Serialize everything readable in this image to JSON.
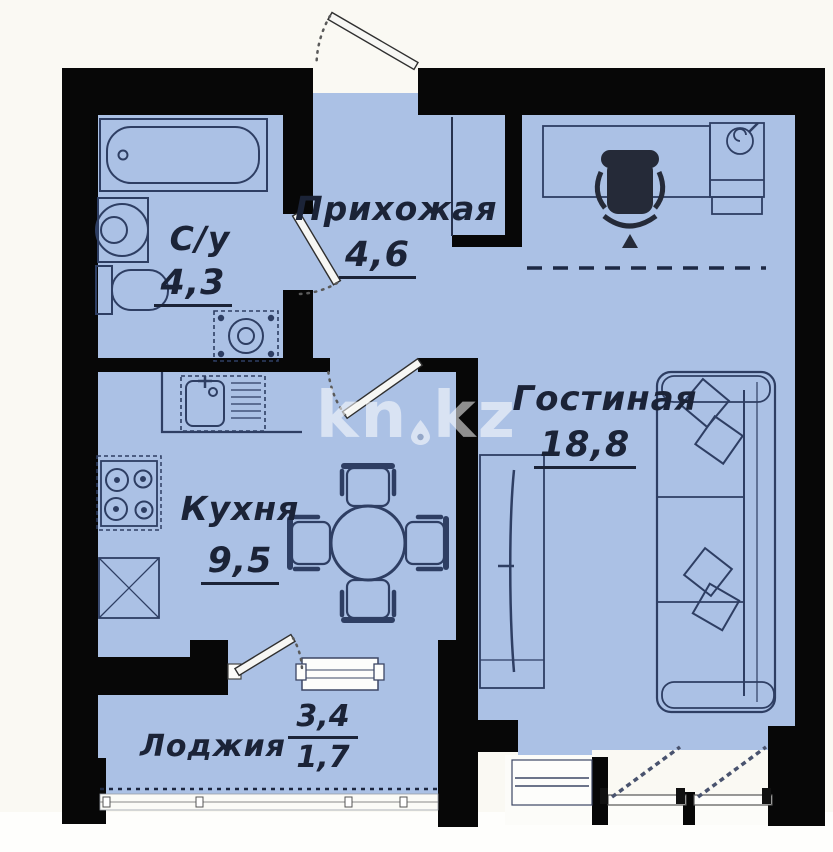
{
  "plan": {
    "title": "apartment-floor-plan",
    "rooms": {
      "hallway": {
        "name": "Прихожая",
        "area": "4,6"
      },
      "bathroom": {
        "name": "С/у",
        "area": "4,3"
      },
      "kitchen": {
        "name": "Кухня",
        "area": "9,5"
      },
      "living": {
        "name": "Гостиная",
        "area": "18,8"
      },
      "loggia": {
        "name": "Лоджия",
        "area_total": "3,4",
        "area_reduced": "1,7"
      }
    },
    "watermark": {
      "part1": "kn",
      "part2": "kz"
    },
    "colors": {
      "wall": "#070707",
      "floor": "#abc1e5",
      "furniture_outline": "#2e3e63",
      "background": "#faf9f3",
      "watermark": "rgba(255,255,255,0.55)"
    }
  }
}
